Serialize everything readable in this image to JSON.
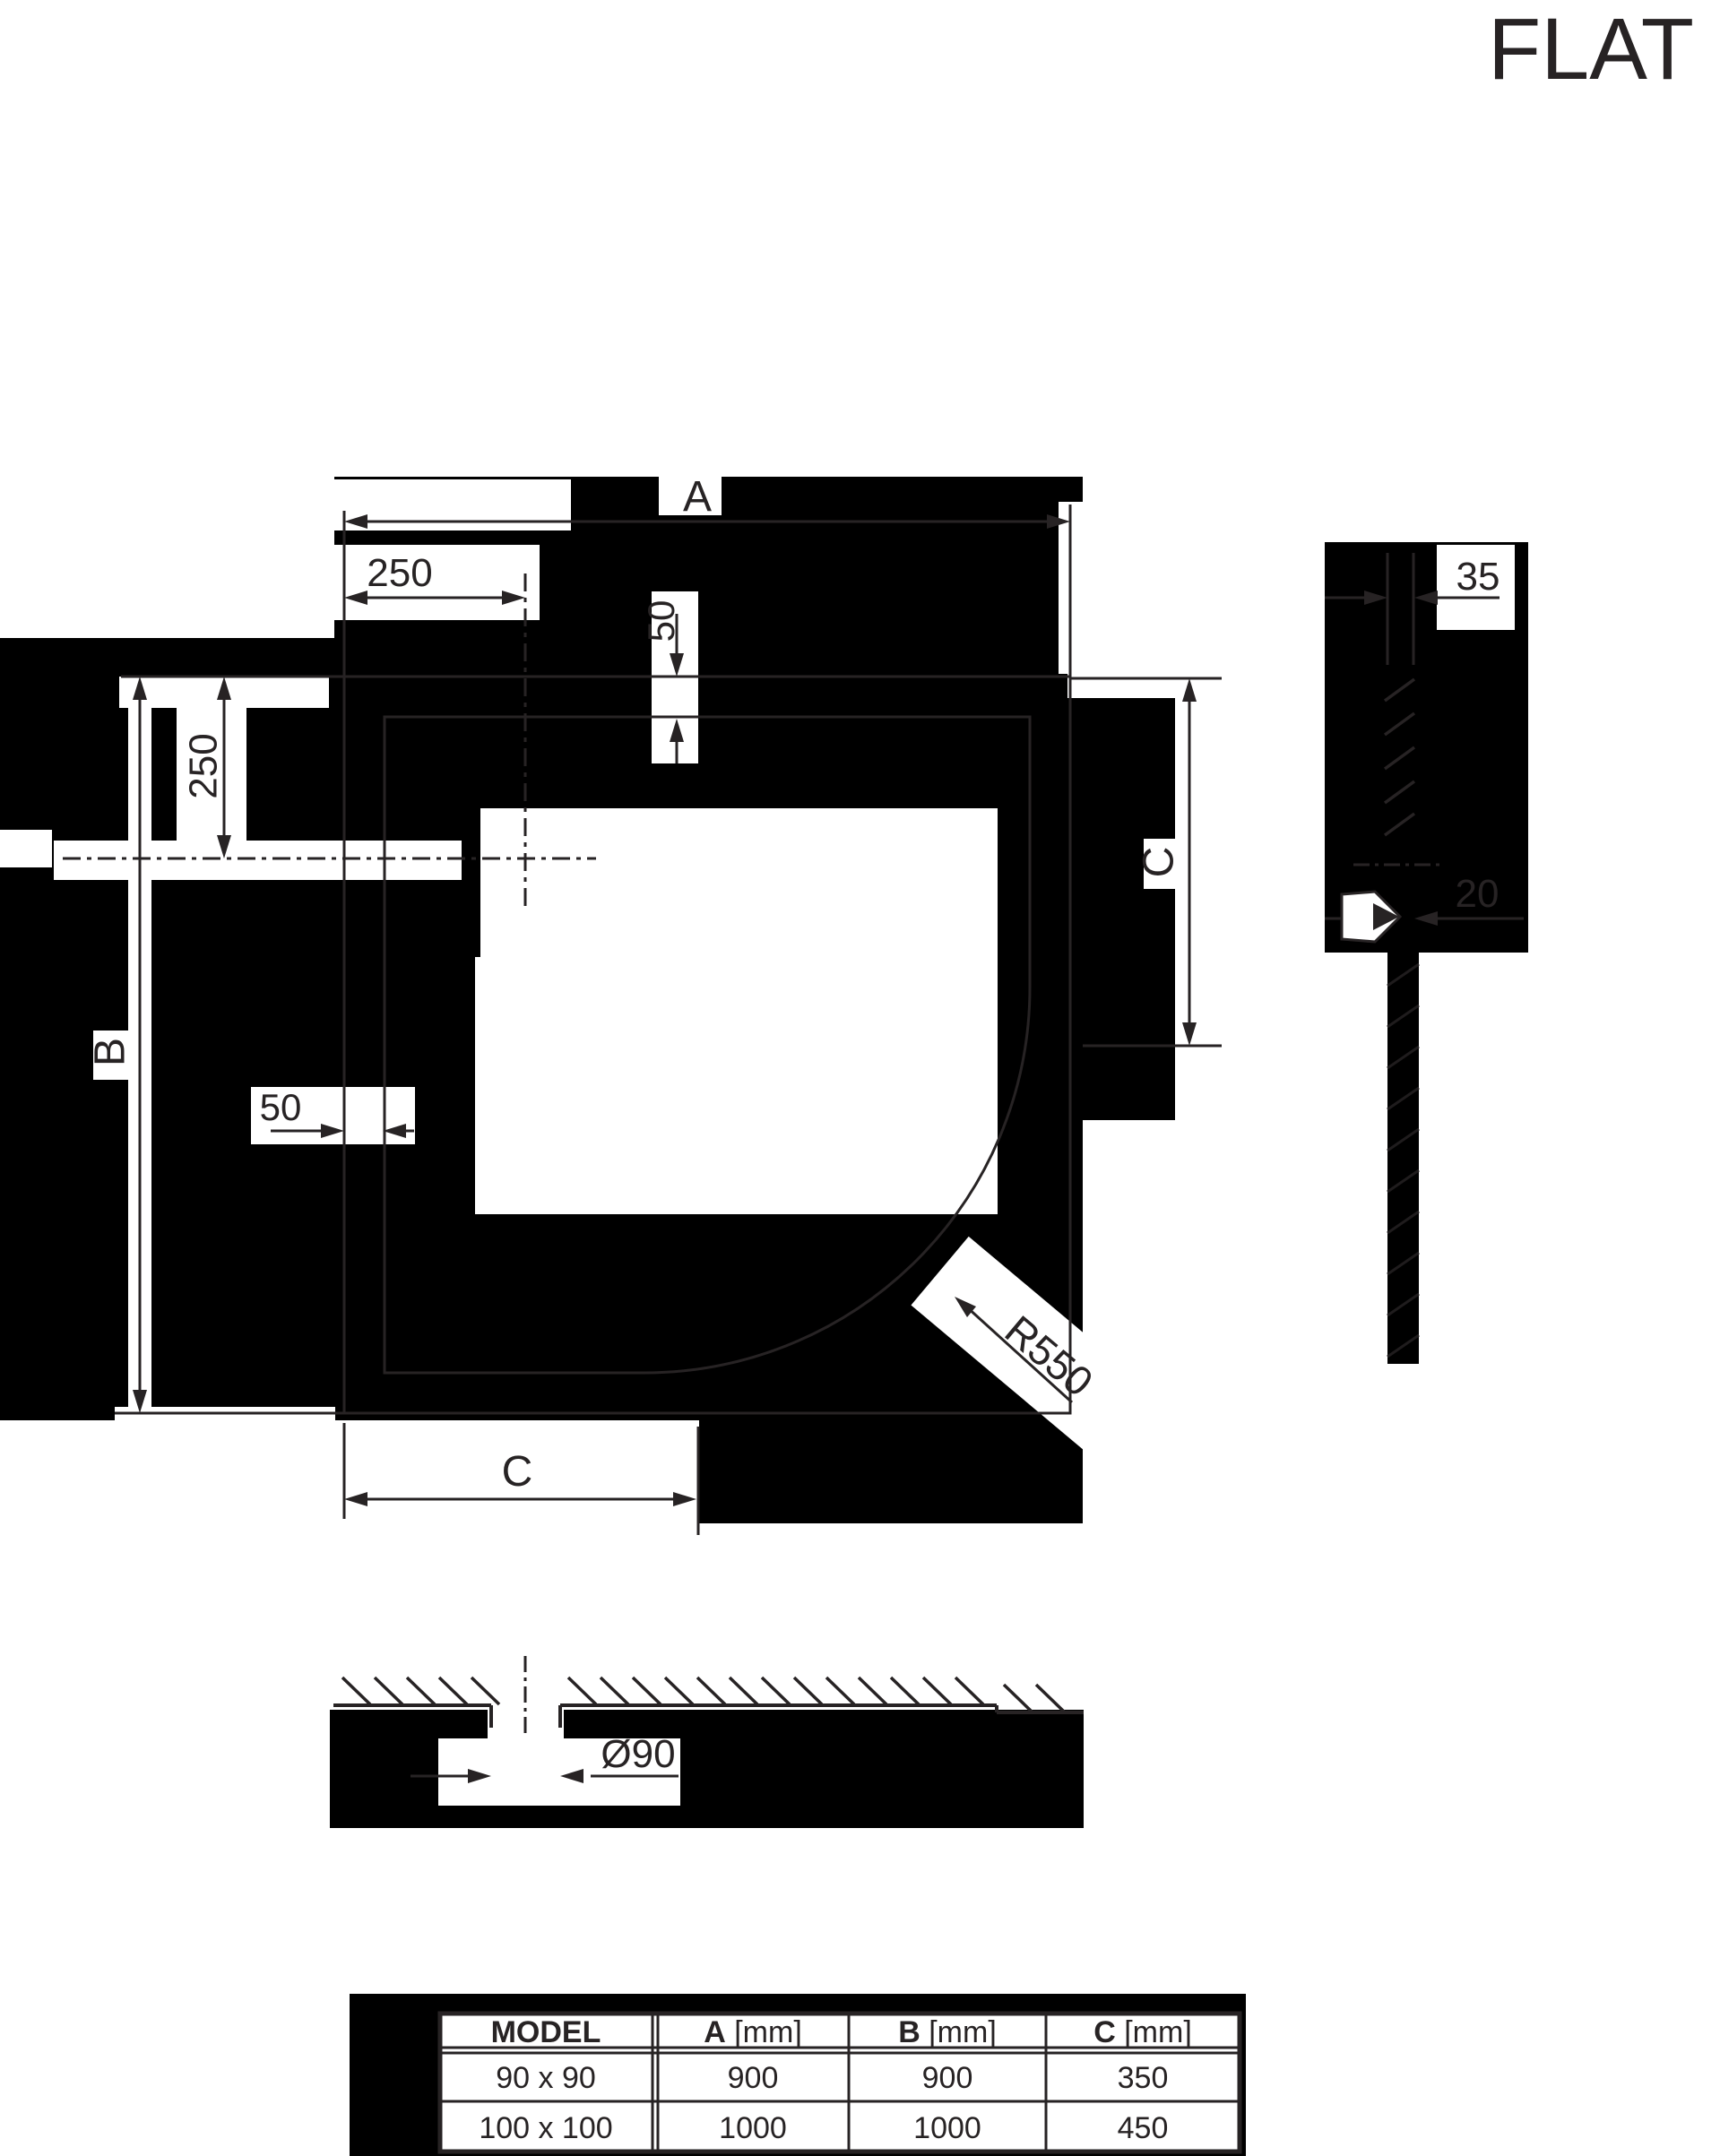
{
  "logo": "FLAT",
  "dims": {
    "width_top": "A",
    "offset_x": "250",
    "offset_y": "250",
    "rim_top": "50",
    "rim_left": "50",
    "height_left": "B",
    "depth_right": "C",
    "corner_radius": "R550",
    "depth_bottom": "C",
    "wall_thickness": "35",
    "pipe_width": "20",
    "drain_diameter": "Ø90"
  },
  "table": {
    "headers": [
      {
        "letter": "MODEL",
        "unit": ""
      },
      {
        "letter": "A",
        "unit": " [mm]"
      },
      {
        "letter": "B",
        "unit": " [mm]"
      },
      {
        "letter": "C",
        "unit": " [mm]"
      }
    ],
    "rows": [
      [
        "90 x 90",
        "900",
        "900",
        "350"
      ],
      [
        "100 x 100",
        "1000",
        "1000",
        "450"
      ]
    ]
  },
  "chart_data": {
    "type": "table",
    "title": "FLAT shower tray dimensions",
    "categories": [
      "90 x 90",
      "100 x 100"
    ],
    "series": [
      {
        "name": "A [mm]",
        "values": [
          900,
          1000
        ]
      },
      {
        "name": "B [mm]",
        "values": [
          900,
          1000
        ]
      },
      {
        "name": "C [mm]",
        "values": [
          350,
          450
        ]
      }
    ]
  }
}
